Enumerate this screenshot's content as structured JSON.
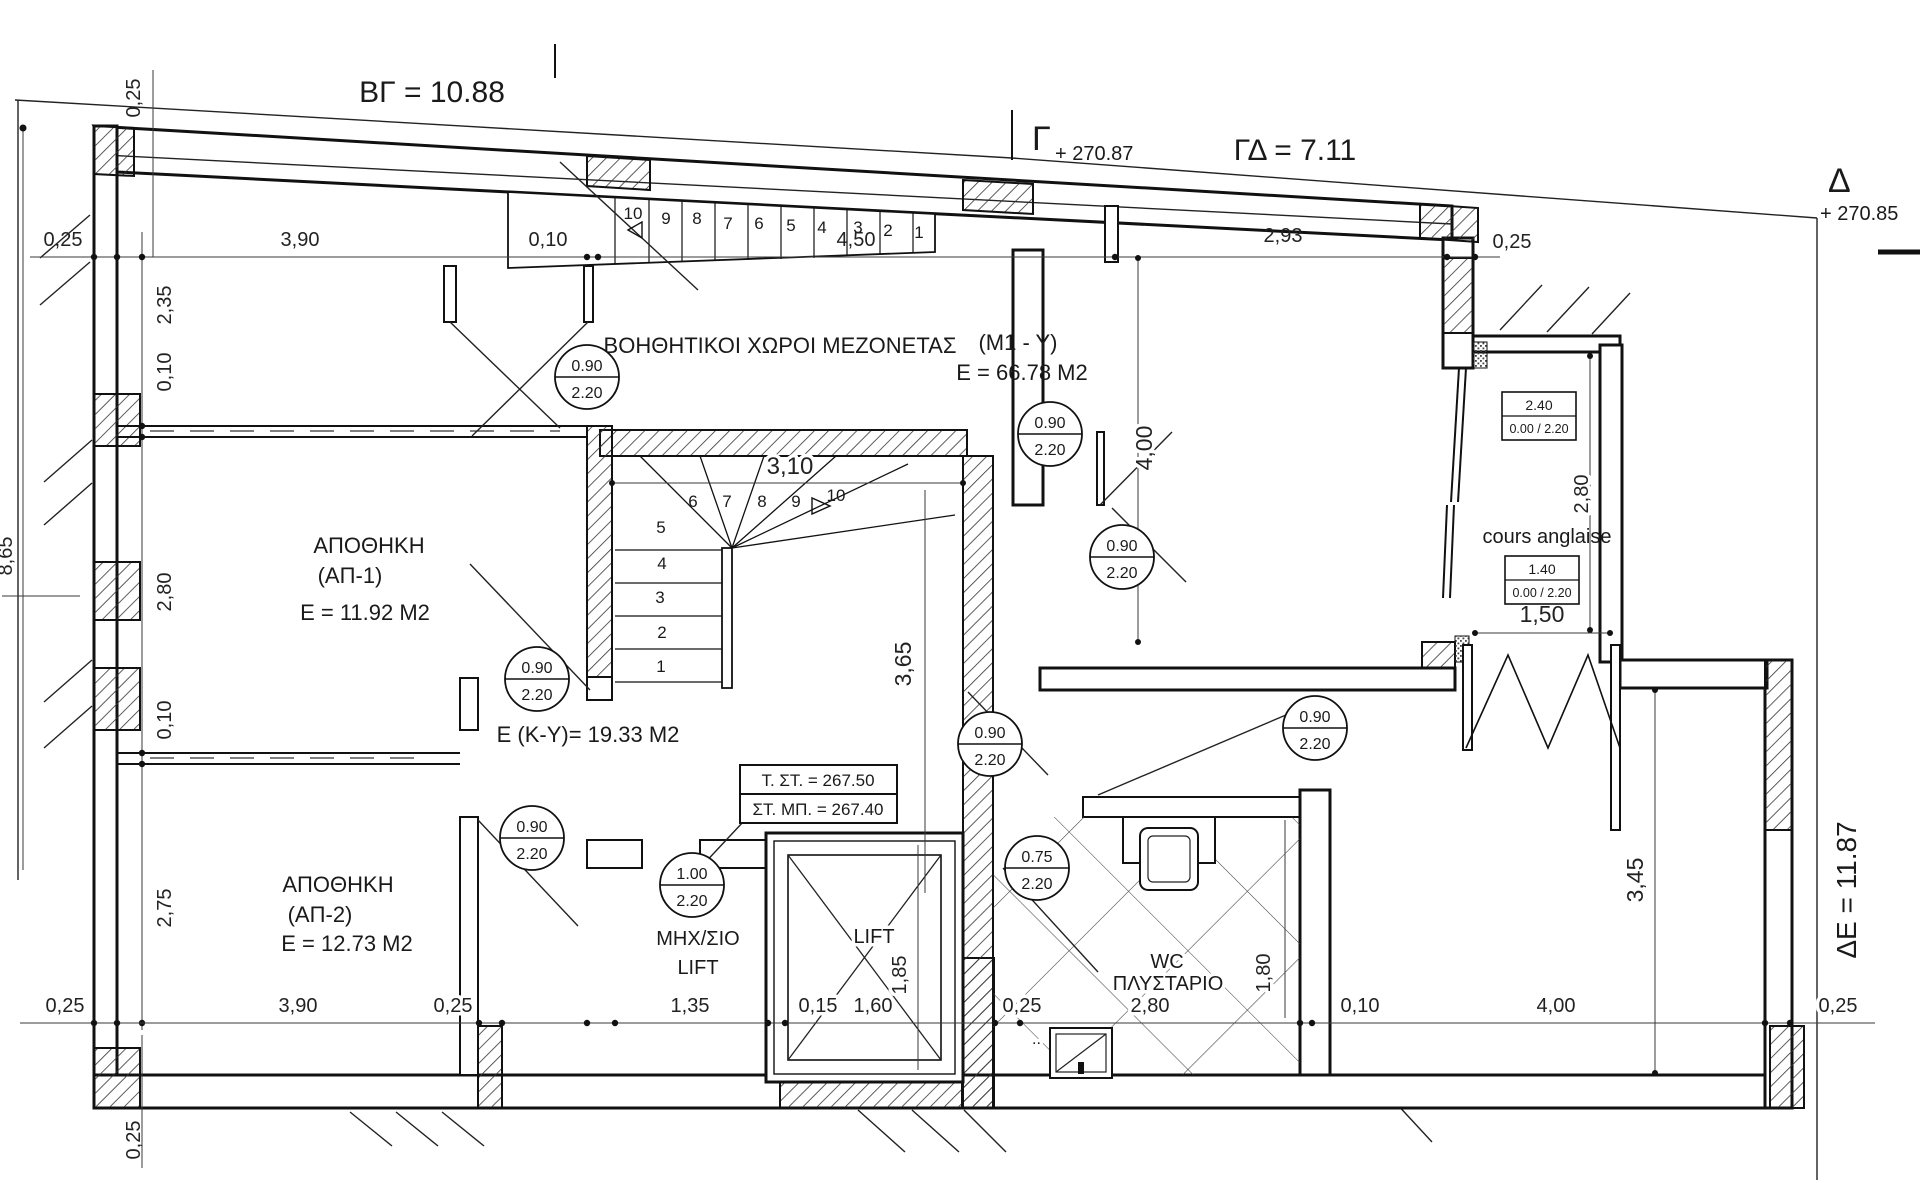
{
  "boundary": {
    "bg": "ΒΓ = 10.88",
    "gamma": "Γ",
    "gamma_level": "+ 270.87",
    "gd": "ΓΔ = 7.11",
    "delta": "Δ",
    "delta_level": "+ 270.85",
    "de": "ΔΕ = 11.87"
  },
  "rooms": {
    "aux_label": "ΒΟΗΘΗΤΙΚΟΙ ΧΩΡΟΙ ΜΕΖΟΝΕΤΑΣ",
    "m1_code": "(M1 - Y)",
    "m1_area": "E = 66.78 M2",
    "ap1_name": "ΑΠΟΘΗΚΗ",
    "ap1_code": "(ΑΠ-1)",
    "ap1_area": "Ε = 11.92 Μ2",
    "ap2_name": "ΑΠΟΘΗΚΗ",
    "ap2_code": "(ΑΠ-2)",
    "ap2_area": "Ε = 12.73 Μ2",
    "ky_area": "Ε (Κ-Υ)= 19.33 Μ2",
    "mhx_line1": "ΜΗΧ/ΣΙΟ",
    "mhx_line2": "LIFT",
    "lift": "LIFT",
    "wc_line1": "WC",
    "wc_line2": "ΠΛΥΣΤΑΡΙΟ",
    "wc_dots": "..",
    "cours": "cours anglaise"
  },
  "levels": {
    "t_st": "Τ. ΣΤ. = 267.50",
    "st_mp": "ΣΤ. ΜΠ. = 267.40"
  },
  "door_tags": [
    {
      "w": "0.90",
      "h": "2.20"
    },
    {
      "w": "0.90",
      "h": "2.20"
    },
    {
      "w": "0.90",
      "h": "2.20"
    },
    {
      "w": "0.90",
      "h": "2.20"
    },
    {
      "w": "0.90",
      "h": "2.20"
    },
    {
      "w": "0.90",
      "h": "2.20"
    },
    {
      "w": "0.90",
      "h": "2.20"
    },
    {
      "w": "0.75",
      "h": "2.20"
    },
    {
      "w": "1.00",
      "h": "2.20"
    }
  ],
  "window_tags": [
    {
      "w": "2.40",
      "sill": "0.00 / 2.20"
    },
    {
      "w": "1.40",
      "sill": "0.00 / 2.20"
    }
  ],
  "dims": {
    "top": [
      "0,25",
      "3,90",
      "0,10",
      "4,50",
      "2,93",
      "0,25"
    ],
    "top_corner": "0,25",
    "left": [
      "2,35",
      "0,10",
      "2,80",
      "0,10",
      "2,75"
    ],
    "left_total": "8,65",
    "left_bottom": "0,25",
    "bottom": [
      "0,25",
      "3,90",
      "0,25",
      "1,35",
      "0,15",
      "1,60",
      "0,25",
      "2,80",
      "0,10",
      "4,00",
      "0,25"
    ],
    "v400": "4,00",
    "v280": "2,80",
    "v150": "1,50",
    "v310": "3,10",
    "v365": "3,65",
    "v185": "1,85",
    "v180": "1,80",
    "v345": "3,45"
  },
  "stairs": {
    "top": [
      "10",
      "9",
      "8",
      "7",
      "6",
      "5",
      "4",
      "3",
      "2",
      "1"
    ],
    "main": [
      "1",
      "2",
      "3",
      "4",
      "5",
      "6",
      "7",
      "8",
      "9",
      "10"
    ]
  }
}
